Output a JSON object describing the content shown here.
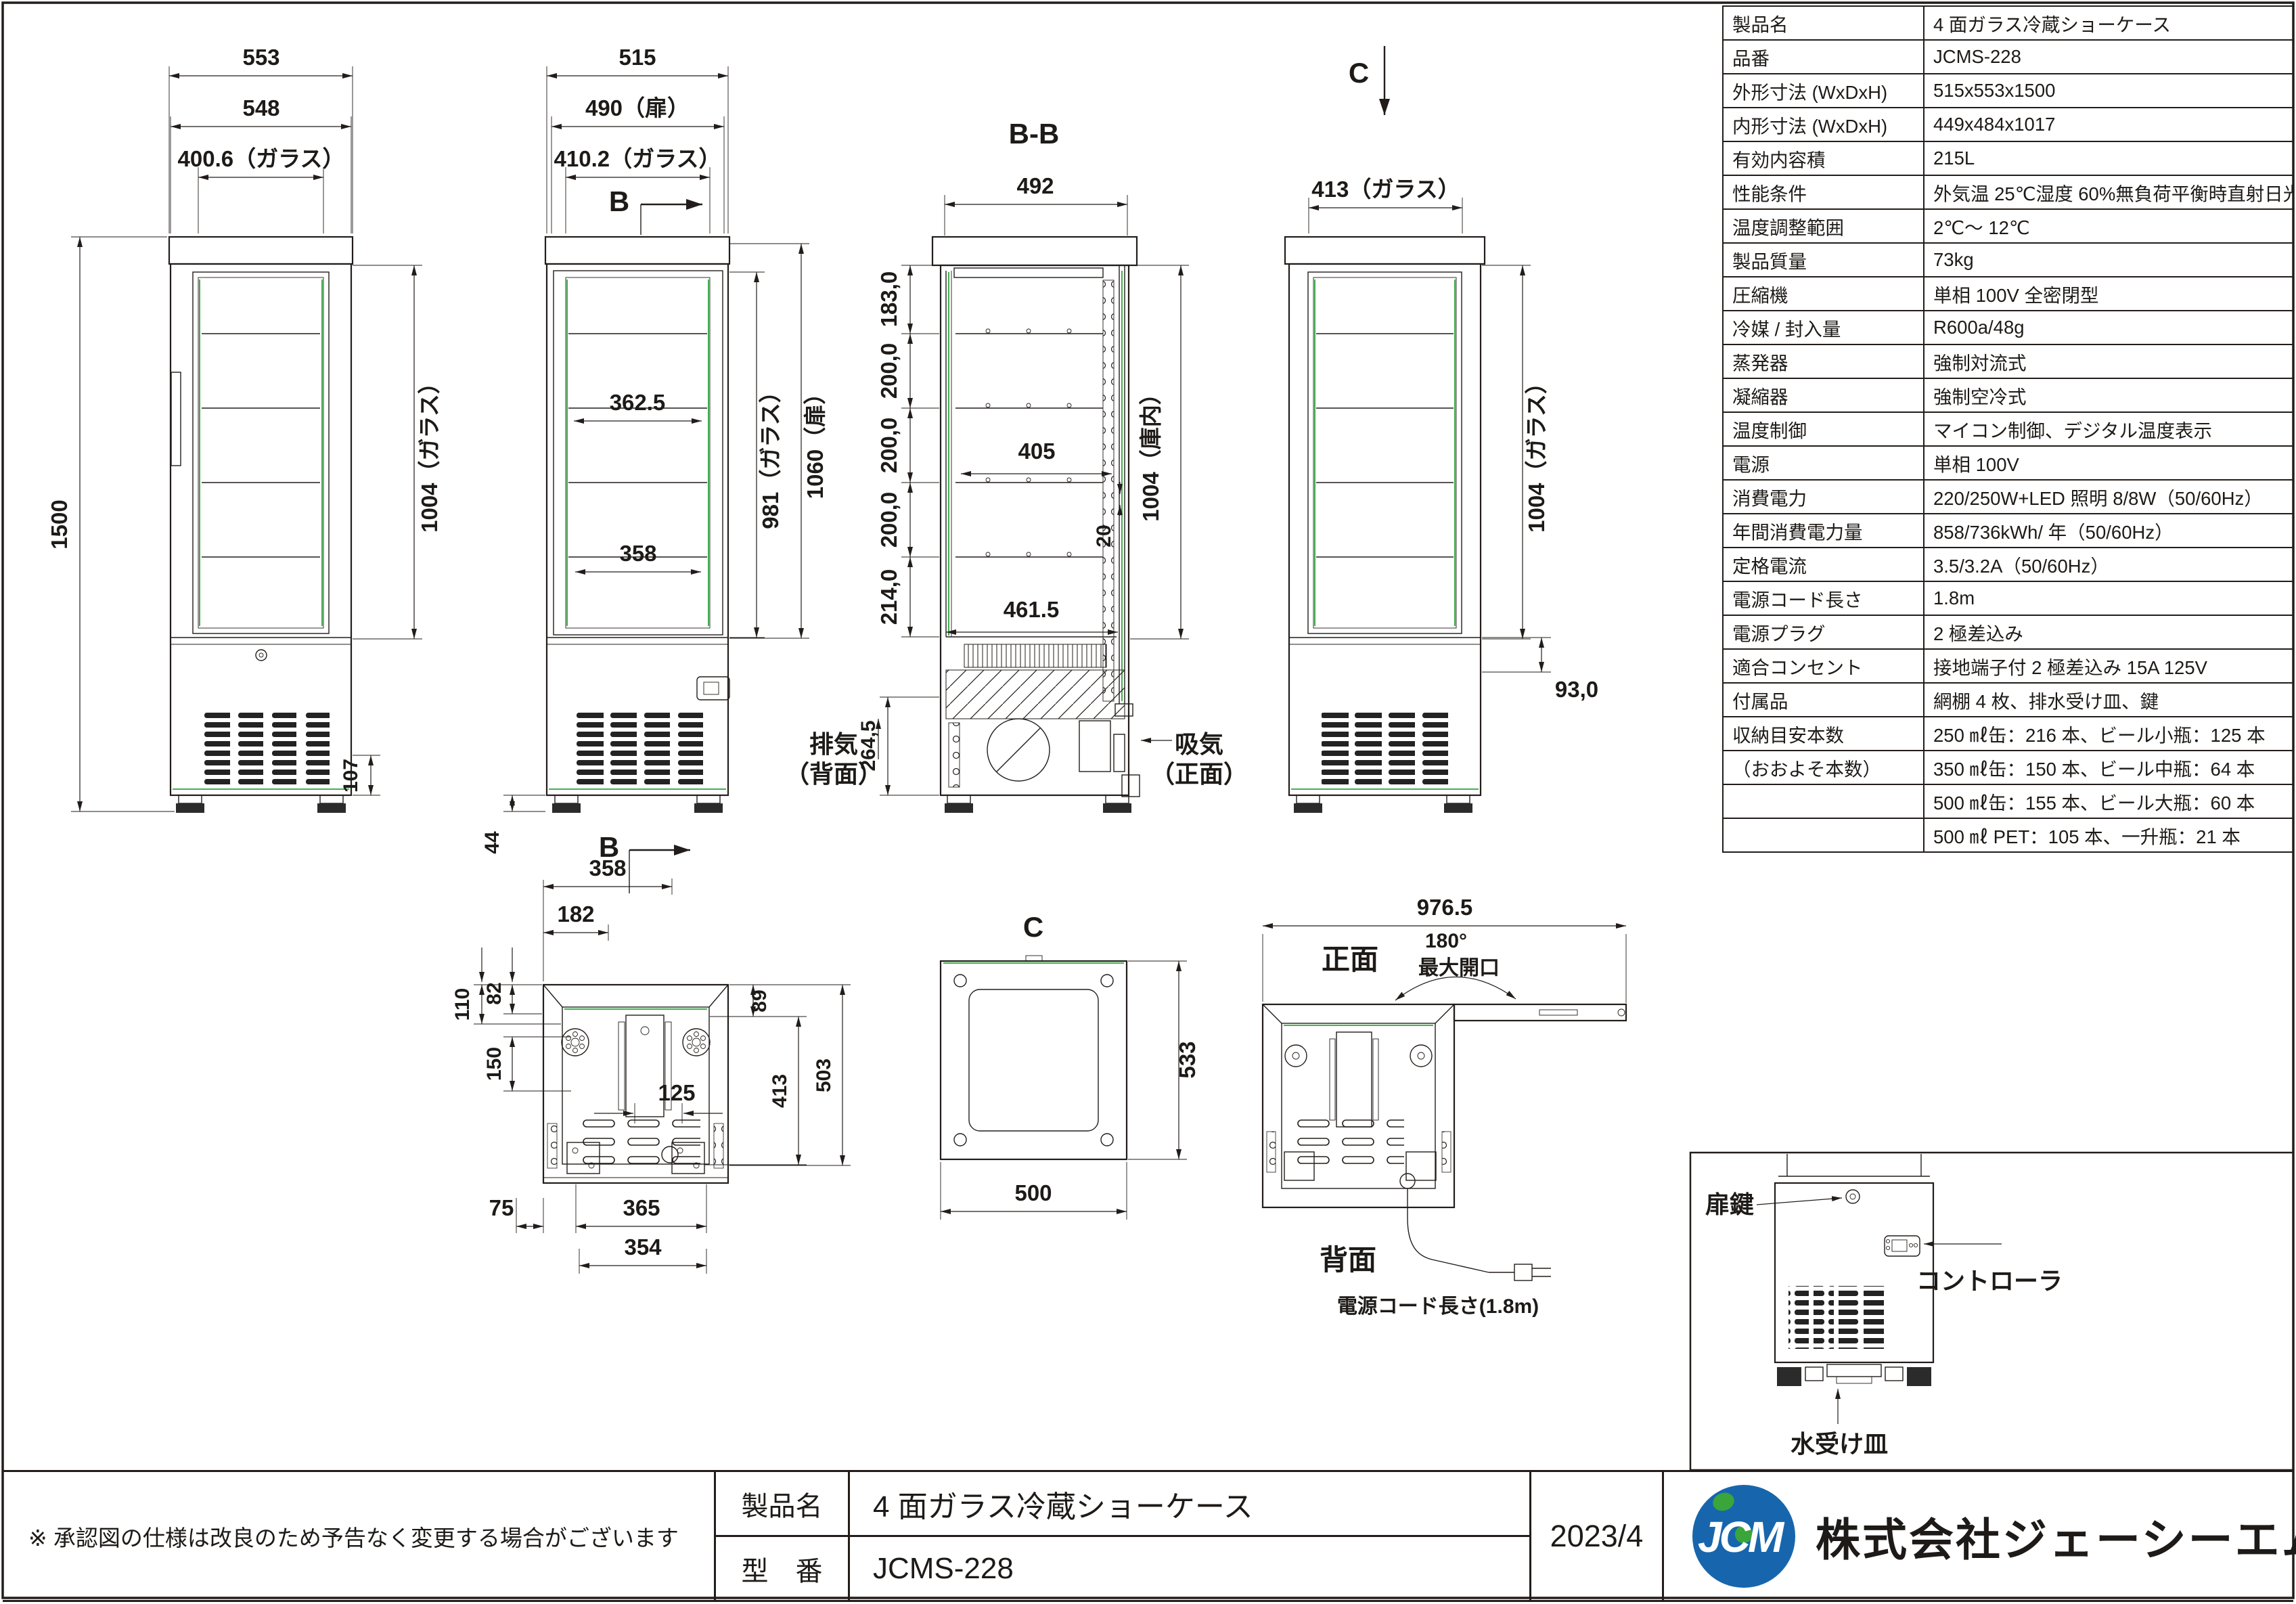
{
  "colors": {
    "line": "#221d1a",
    "accent_green": "#2ea33c",
    "logo_blue": "#1766ad",
    "logo_green": "#3aa53a"
  },
  "sheet": {
    "note": "※ 承認図の仕様は改良のため予告なく変更する場合がございます",
    "product_label": "製品名",
    "product_value": "4 面ガラス冷蔵ショーケース",
    "model_label": "型　番",
    "model_value": "JCMS-228",
    "date": "2023/4",
    "logo_text": "JCM",
    "company": "株式会社ジェーシーエム"
  },
  "spec": {
    "rows": [
      {
        "label": "製品名",
        "value": "4 面ガラス冷蔵ショーケース"
      },
      {
        "label": "品番",
        "value": "JCMS-228"
      },
      {
        "label": "外形寸法 (WxDxH)",
        "value": "515x553x1500"
      },
      {
        "label": "内形寸法 (WxDxH)",
        "value": "449x484x1017"
      },
      {
        "label": "有効内容積",
        "value": "215L"
      },
      {
        "label": "性能条件",
        "value": "外気温 25℃湿度 60%無負荷平衡時直射日光受けず"
      },
      {
        "label": "温度調整範囲",
        "value": "2℃～ 12℃"
      },
      {
        "label": "製品質量",
        "value": "73kg"
      },
      {
        "label": "圧縮機",
        "value": "単相 100V 全密閉型"
      },
      {
        "label": "冷媒 / 封入量",
        "value": "R600a/48g"
      },
      {
        "label": "蒸発器",
        "value": "強制対流式"
      },
      {
        "label": "凝縮器",
        "value": "強制空冷式"
      },
      {
        "label": "温度制御",
        "value": "マイコン制御、デジタル温度表示"
      },
      {
        "label": "電源",
        "value": "単相 100V"
      },
      {
        "label": "消費電力",
        "value": "220/250W+LED 照明 8/8W（50/60Hz）"
      },
      {
        "label": "年間消費電力量",
        "value": "858/736kWh/ 年（50/60Hz）"
      },
      {
        "label": "定格電流",
        "value": "3.5/3.2A（50/60Hz）"
      },
      {
        "label": "電源コード長さ",
        "value": "1.8m"
      },
      {
        "label": "電源プラグ",
        "value": "2 極差込み"
      },
      {
        "label": "適合コンセント",
        "value": "接地端子付 2 極差込み 15A 125V"
      },
      {
        "label": "付属品",
        "value": "網棚 4 枚、排水受け皿、鍵"
      },
      {
        "label": "収納目安本数",
        "value": "250 ㎖缶：216 本、ビール小瓶：125 本"
      },
      {
        "label": "（おおよそ本数）",
        "value": "350 ㎖缶：150 本、ビール中瓶：64 本"
      },
      {
        "label": "",
        "value": "500 ㎖缶：155 本、ビール大瓶：60 本"
      },
      {
        "label": "",
        "value": "500 ㎖ PET：105 本、一升瓶：21 本"
      }
    ]
  },
  "views": {
    "side_view": {
      "dim_overall": "553",
      "dim_body": "548",
      "dim_glass": "400.6（ガラス）",
      "dim_height": "1500",
      "dim_glass_h": "1004（ガラス）",
      "dim_vent": "107"
    },
    "front_view": {
      "dim_overall": "515",
      "dim_door": "490（扉）",
      "dim_glass": "410.2（ガラス）",
      "section_mark": "B",
      "section_mark_bottom": "B",
      "dim_glass_h": "981（ガラス）",
      "dim_door_h": "1060（扉）",
      "dim_shelf_upper": "362.5",
      "dim_shelf_lower": "358",
      "dim_foot": "44"
    },
    "section_bb": {
      "title": "B-B",
      "dim_width": "492",
      "seg1": "183,0",
      "seg2": "200,0",
      "seg3": "200,0",
      "seg4": "200,0",
      "seg5": "214,0",
      "dim_machine": "264,5",
      "dim_shelf": "405",
      "dim_floor": "461.5",
      "dim_gap": "20",
      "dim_inner_h": "1004（庫内）",
      "exhaust_line1": "排気",
      "exhaust_line2": "（背面）",
      "intake_line1": "吸気",
      "intake_line2": "（正面）"
    },
    "back_view": {
      "section_mark": "C",
      "dim_glass": "413（ガラス）",
      "dim_glass_h": "1004（ガラス）",
      "dim_base": "93,0"
    },
    "bottom_view": {
      "dim_base_w": "358",
      "dim_a": "182",
      "dim_b": "110",
      "dim_c": "82",
      "dim_d": "150",
      "dim_e": "125",
      "dim_f": "89",
      "dim_g": "413",
      "dim_h": "503",
      "dim_i": "365",
      "dim_j": "354",
      "dim_k": "75"
    },
    "section_c": {
      "title": "C",
      "dim_w": "500",
      "dim_h": "533"
    },
    "rear_open": {
      "dim_total": "976.5",
      "front_label": "正面",
      "angle": "180°",
      "angle_note": "最大開口",
      "rear_label": "背面",
      "cord_note": "電源コード長さ(1.8m)"
    },
    "detail": {
      "lock_label": "扉鍵",
      "controller_label": "コントローラ",
      "drain_label": "水受け皿"
    }
  }
}
